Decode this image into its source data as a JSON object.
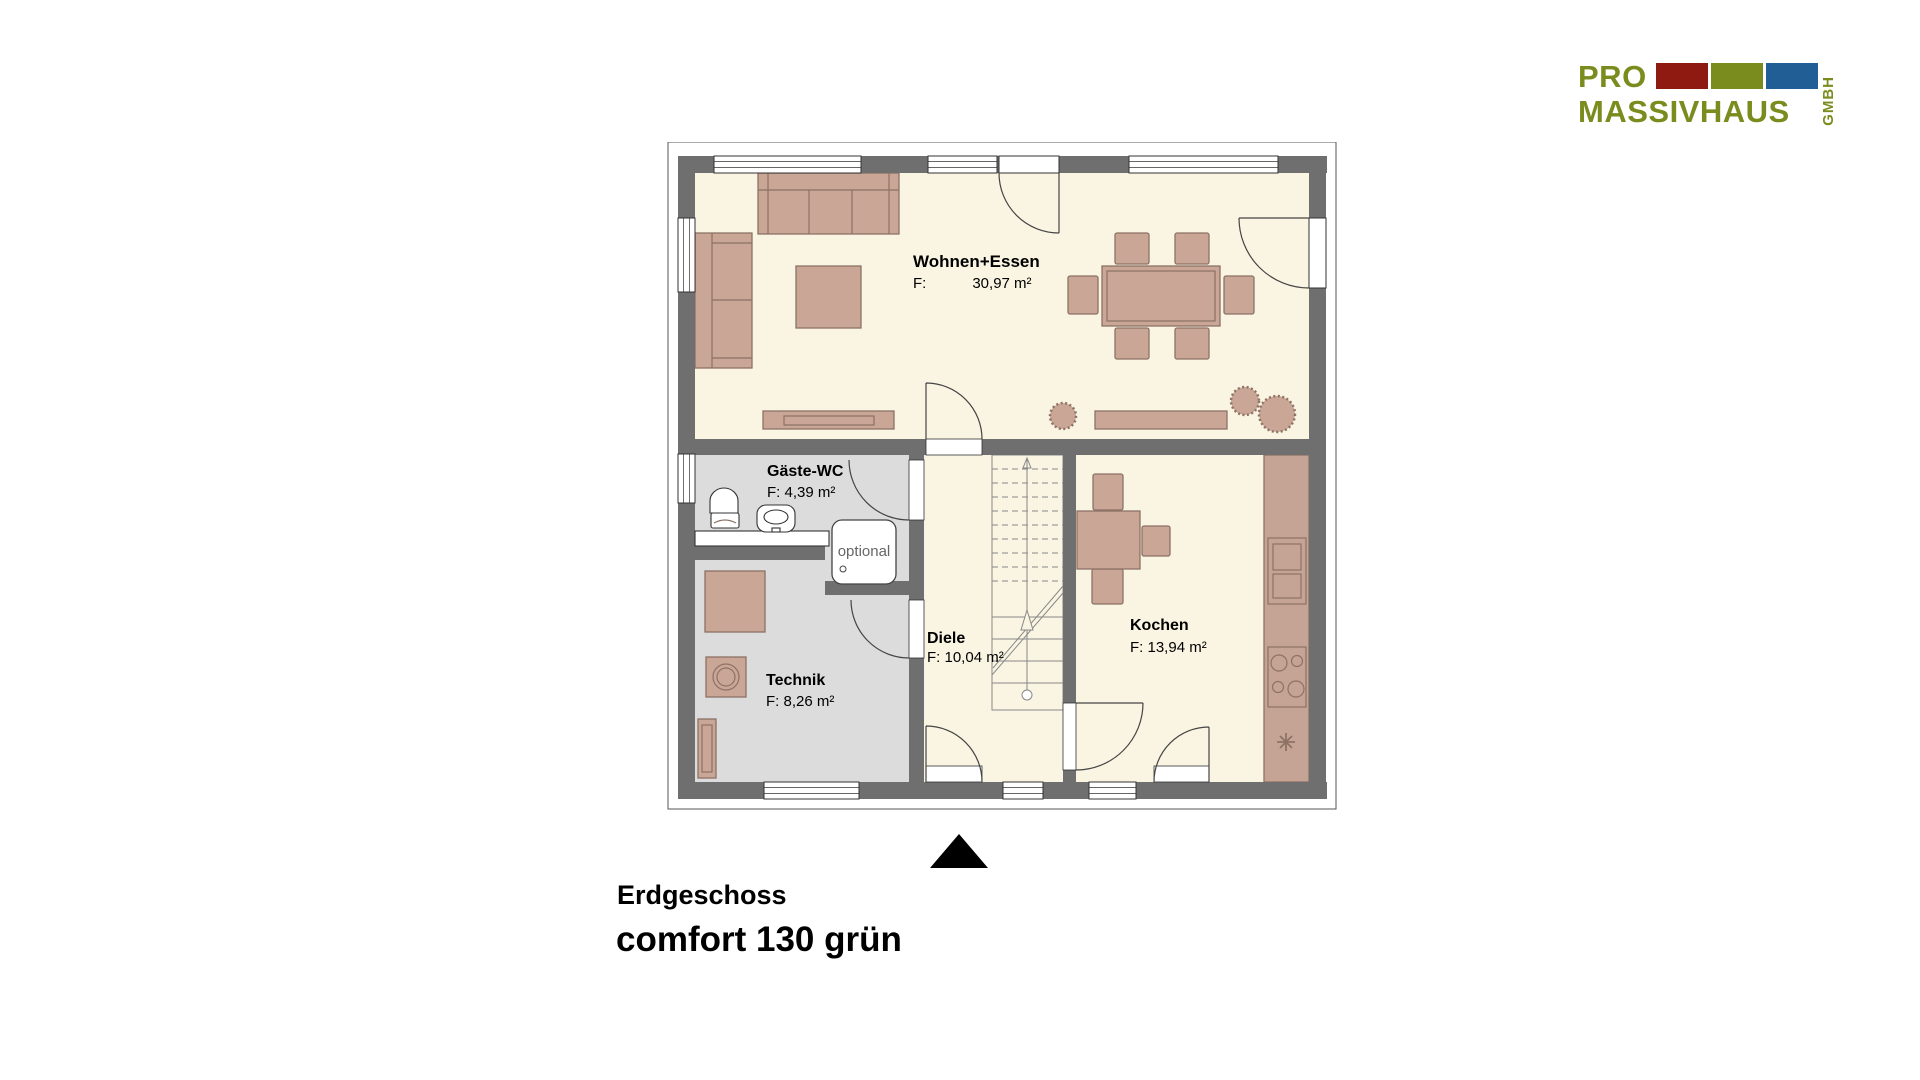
{
  "logo": {
    "pro": "PRO",
    "massivhaus": "MASSIVHAUS",
    "gmbh": "GMBH",
    "colors": {
      "olive": "#7A8C1E",
      "red": "#8E1A12",
      "blue": "#215E96"
    }
  },
  "titles": {
    "floor": "Erdgeschoss",
    "model": "comfort 130 grün"
  },
  "rooms": {
    "wohnen": {
      "name": "Wohnen+Essen",
      "area_label": "F:",
      "area_value": "30,97 m²"
    },
    "wc": {
      "name": "Gäste-WC",
      "area": "F: 4,39 m²"
    },
    "technik": {
      "name": "Technik",
      "area": "F: 8,26 m²"
    },
    "diele": {
      "name": "Diele",
      "area": "F: 10,04 m²"
    },
    "kochen": {
      "name": "Kochen",
      "area": "F: 13,94 m²"
    }
  },
  "annotations": {
    "shower_optional": "optional"
  },
  "palette": {
    "wall": "#6F6F6F",
    "floor_main": "#FAF5E2",
    "floor_grey": "#DCDCDC",
    "furniture": "#C9A696",
    "furniture_outline": "#8D7265"
  }
}
